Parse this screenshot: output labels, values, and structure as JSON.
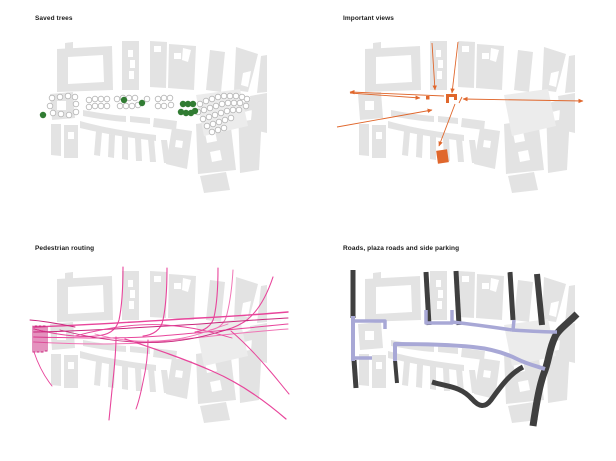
{
  "page": {
    "background": "#ffffff"
  },
  "basemap": {
    "building_fill": "#e3e3e3",
    "shapes": [
      {
        "d": "M57,49 L112,46 L113,90 L57,92 Z M68,57 L103,55 L104,82 L68,84 Z"
      },
      {
        "d": "M65,43 L73,42 L73,49 L65,49 Z"
      },
      {
        "d": "M122,41 L139,41 L139,90 L122,90 Z M128,50 L133,50 L133,57 L128,57 Z M130,60 L135,60 L135,68 L130,68 Z M129,71 L134,71 L134,79 L129,79 Z"
      },
      {
        "d": "M150,41 L167,42 L166,88 L150,87 Z M154,46 L161,46 L161,52 L154,52 Z"
      },
      {
        "d": "M169,44 L196,46 L194,90 L168,88 Z M174,53 L181,53 L181,59 L174,59 Z M183,48 L191,50 L188,62 L182,60 Z"
      },
      {
        "d": "M210,50 L225,52 L221,92 L206,90 Z"
      },
      {
        "d": "M236,47 L258,54 L253,74 L248,92 L234,90 Z M243,73 L251,71 L248,87 L241,85 Z"
      },
      {
        "d": "M261,56 L267,55 L267,92 L257,93 Z"
      },
      {
        "d": "M50,94 L73,92 L75,118 L52,120 Z M57,101 L66,101 L66,110 L57,110 Z"
      },
      {
        "d": "M83,110 C100,113 112,115 126,116 L126,122 C112,121 100,119 83,116 Z"
      },
      {
        "d": "M130,116 L150,118 L150,124 L130,122 Z"
      },
      {
        "d": "M154,118 L177,121 L176,130 L153,127 Z"
      },
      {
        "d": "M51,124 L61,124 L61,156 L51,155 Z"
      },
      {
        "d": "M64,125 L78,125 L78,158 L64,158 Z M68,132 L74,132 L74,139 L68,139 Z"
      },
      {
        "d": "M80,121 C105,128 130,132 156,135 L156,141 C130,138 105,134 80,128 Z"
      },
      {
        "d": "M96,131 L102,132 L100,156 L94,155 Z"
      },
      {
        "d": "M109,134 L115,135 L114,158 L108,157 Z"
      },
      {
        "d": "M122,136 L128,137 L128,160 L122,159 Z"
      },
      {
        "d": "M135,138 L141,138 L142,161 L136,161 Z"
      },
      {
        "d": "M148,139 L154,139 L156,162 L150,162 Z"
      },
      {
        "d": "M161,140 L167,140 L170,163 L164,163 Z"
      },
      {
        "d": "M172,128 L192,131 L187,169 L166,164 Z M176,140 L183,141 L182,148 L175,147 Z"
      },
      {
        "d": "M196,124 L230,119 L236,170 L198,174 Z M205,133 L215,131 L217,141 L207,143 Z M210,152 L220,150 L222,160 L212,162 Z"
      },
      {
        "d": "M238,104 L263,96 L259,170 L240,173 Z M244,112 L252,110 L251,120 L243,121 Z"
      },
      {
        "d": "M196,95 L240,89 L248,126 L204,136 Z",
        "fill": "#ececec"
      },
      {
        "d": "M250,96 L267,93 L267,133 L254,130 Z"
      },
      {
        "d": "M200,176 L226,172 L230,190 L204,193 Z"
      }
    ]
  },
  "panels": {
    "saved_trees": {
      "title": "Saved trees",
      "saved_tree_color": "#317c33",
      "saved_tree_radius": 3.2,
      "other_tree_color": "#b3b3b3",
      "other_tree_radius": 2.8,
      "saved_tree_positions": [
        [
          43,
          115
        ],
        [
          124,
          100
        ],
        [
          142,
          103
        ],
        [
          183,
          104
        ],
        [
          188,
          104
        ],
        [
          193,
          104
        ],
        [
          181,
          112
        ],
        [
          186,
          113
        ],
        [
          191,
          113
        ],
        [
          195,
          111
        ]
      ],
      "other_trees": [
        [
          52,
          98
        ],
        [
          60,
          97
        ],
        [
          68,
          96
        ],
        [
          75,
          97
        ],
        [
          50,
          106
        ],
        [
          76,
          104
        ],
        [
          53,
          113
        ],
        [
          61,
          114
        ],
        [
          69,
          115
        ],
        [
          76,
          112
        ],
        [
          89,
          100
        ],
        [
          95,
          99
        ],
        [
          101,
          99
        ],
        [
          107,
          99
        ],
        [
          89,
          107
        ],
        [
          95,
          106
        ],
        [
          101,
          106
        ],
        [
          107,
          106
        ],
        [
          117,
          99
        ],
        [
          123,
          98
        ],
        [
          129,
          98
        ],
        [
          135,
          98
        ],
        [
          147,
          99
        ],
        [
          120,
          106
        ],
        [
          126,
          106
        ],
        [
          132,
          106
        ],
        [
          138,
          105
        ],
        [
          158,
          99
        ],
        [
          164,
          98
        ],
        [
          170,
          98
        ],
        [
          158,
          106
        ],
        [
          164,
          106
        ],
        [
          171,
          105
        ],
        [
          200,
          104
        ],
        [
          206,
          101
        ],
        [
          212,
          99
        ],
        [
          218,
          97
        ],
        [
          224,
          96
        ],
        [
          230,
          96
        ],
        [
          236,
          96
        ],
        [
          242,
          97
        ],
        [
          247,
          99
        ],
        [
          198,
          112
        ],
        [
          204,
          110
        ],
        [
          210,
          108
        ],
        [
          216,
          106
        ],
        [
          222,
          104
        ],
        [
          228,
          103
        ],
        [
          234,
          103
        ],
        [
          240,
          103
        ],
        [
          246,
          106
        ],
        [
          203,
          119
        ],
        [
          209,
          117
        ],
        [
          215,
          115
        ],
        [
          221,
          113
        ],
        [
          227,
          111
        ],
        [
          233,
          110
        ],
        [
          239,
          110
        ],
        [
          207,
          126
        ],
        [
          213,
          124
        ],
        [
          219,
          122
        ],
        [
          225,
          120
        ],
        [
          231,
          118
        ],
        [
          212,
          132
        ],
        [
          218,
          130
        ],
        [
          224,
          128
        ]
      ]
    },
    "important_views": {
      "title": "Important views",
      "color": "#e0672c",
      "view_lines": [
        {
          "x1": 42,
          "y1": 92,
          "x2": 136,
          "y2": 96,
          "head_start": true
        },
        {
          "x1": 42,
          "y1": 93,
          "x2": 112,
          "y2": 98,
          "head_end": true
        },
        {
          "x1": 155,
          "y1": 99,
          "x2": 275,
          "y2": 101,
          "head_start": true,
          "head_end": true
        },
        {
          "x1": 29,
          "y1": 127,
          "x2": 124,
          "y2": 110,
          "head_end": true
        },
        {
          "x1": 124,
          "y1": 43,
          "x2": 127,
          "y2": 90,
          "head_end": true
        },
        {
          "x1": 150,
          "y1": 42,
          "x2": 144,
          "y2": 93,
          "head_end": true
        },
        {
          "x1": 147,
          "y1": 104,
          "x2": 131,
          "y2": 146,
          "head_end": true
        },
        {
          "x1": 151,
          "y1": 103,
          "x2": 154,
          "y2": 97
        }
      ],
      "focus_building_glyph": "M138,103 L138,94 L149,94 L149,100 L146,100 L146,97 L141,97 L141,103 Z",
      "small_square": {
        "x": 118,
        "y": 96,
        "w": 3.5,
        "h": 3.5
      },
      "big_square": {
        "x": 129,
        "y": 150,
        "w": 11,
        "h": 13,
        "rotate": -8
      }
    },
    "pedestrian_routing": {
      "title": "Pedestrian routing",
      "colors": {
        "main": "#e8459b",
        "dark": "#c9267c",
        "light": "#f075b5"
      },
      "routes": [
        {
          "d": "M123,37 C123,58 122,76 119,90 C116,101 108,105 96,106 C75,108 50,103 34,99",
          "c": "main",
          "w": 1.1
        },
        {
          "d": "M167,38 C167,58 166,76 163,90 C161,100 153,105 143,106",
          "c": "main",
          "w": 1.1
        },
        {
          "d": "M218,38 C218,56 217,74 214,87 C212,96 204,101 195,102",
          "c": "main",
          "w": 1.1
        },
        {
          "d": "M233,40 C232,58 230,72 227,84 C225,94 218,99 210,100",
          "c": "light",
          "w": 1
        },
        {
          "d": "M273,47 C266,68 256,84 244,92 C236,97 228,100 220,101",
          "c": "main",
          "w": 1.1
        },
        {
          "d": "M34,97 C90,95 150,91 200,88 C235,86 265,84 288,82",
          "c": "main",
          "w": 1.4
        },
        {
          "d": "M34,102 C90,101 150,97 200,94 C240,91 268,89 288,88",
          "c": "dark",
          "w": 1
        },
        {
          "d": "M34,107 C80,108 120,109 160,106 C200,103 245,98 288,94",
          "c": "main",
          "w": 1
        },
        {
          "d": "M34,112 C70,114 105,115 140,113 C185,110 230,103 288,99",
          "c": "light",
          "w": 1
        },
        {
          "d": "M60,100 C95,109 130,114 165,112 C195,110 215,103 230,99",
          "c": "dark",
          "w": 0.9
        },
        {
          "d": "M75,106 C105,98 135,93 165,95 C195,97 215,103 232,108",
          "c": "main",
          "w": 0.9
        },
        {
          "d": "M95,104 C120,111 145,113 170,110 C195,107 210,100 228,94",
          "c": "light",
          "w": 0.9
        },
        {
          "d": "M116,107 C116,124 114,142 112,160 C111,170 110,180 109,190",
          "c": "main",
          "w": 1.1
        },
        {
          "d": "M148,110 C148,124 146,139 143,152 C141,162 139,171 136,179",
          "c": "main",
          "w": 1
        },
        {
          "d": "M125,109 C155,119 185,129 212,141 C240,153 264,170 286,189",
          "c": "main",
          "w": 1.2
        },
        {
          "d": "M231,101 C245,113 259,128 270,141 C277,149 283,157 289,164",
          "c": "main",
          "w": 1
        },
        {
          "d": "M33,96 L33,122 L35,122 L35,96 L37,96 L37,122 L39,122 L39,96 L41,96 L41,122 L43,122 L43,96 L45,96 L45,121 L47,121 L47,97",
          "c": "dark",
          "w": 1
        },
        {
          "d": "M34,122 C38,134 44,146 52,156",
          "c": "main",
          "w": 0.9
        },
        {
          "d": "M30,90 C45,91 60,94 75,97",
          "c": "dark",
          "w": 0.9
        }
      ]
    },
    "roads": {
      "title": "Roads, plaza roads and side parking",
      "colors": {
        "road": "#3f3f3f",
        "plaza": "#a8a8d6"
      },
      "dark_roads": [
        {
          "d": "M45,40 L45,88",
          "w": 5
        },
        {
          "d": "M46,130 L48,158",
          "w": 5
        },
        {
          "d": "M118,42 L121,95",
          "w": 5
        },
        {
          "d": "M148,41 L151,95",
          "w": 5
        },
        {
          "d": "M202,42 L205,90",
          "w": 5
        },
        {
          "d": "M229,44 L234,95",
          "w": 6
        },
        {
          "d": "M269,84 C259,94 250,100 247,107 C241,119 241,131 236,143 C231,157 228,176 225,196",
          "w": 7
        },
        {
          "d": "M124,152 C140,157 152,156 164,169 C171,177 177,178 183,170 C191,159 201,144 215,137",
          "w": 5
        },
        {
          "d": "M87,130 L89,153",
          "w": 4
        }
      ],
      "plaza_roads": [
        {
          "d": "M45,86 L45,131",
          "w": 4
        },
        {
          "d": "M45,91 L77,91 L77,99",
          "w": 3.5
        },
        {
          "d": "M45,128 L64,128",
          "w": 3.5
        },
        {
          "d": "M118,80 L118,93 L144,93 L144,80",
          "w": 3.5
        },
        {
          "d": "M144,92 C162,94 184,97 204,100",
          "w": 3.5
        },
        {
          "d": "M205,100 L206,90",
          "w": 3.5
        },
        {
          "d": "M204,100 C220,101 236,102 249,102",
          "w": 3.5
        },
        {
          "d": "M87,131 L87,114 C105,114 135,114 165,117 C185,119 199,124 209,129 C219,134 228,136 237,139",
          "w": 4
        }
      ]
    }
  }
}
